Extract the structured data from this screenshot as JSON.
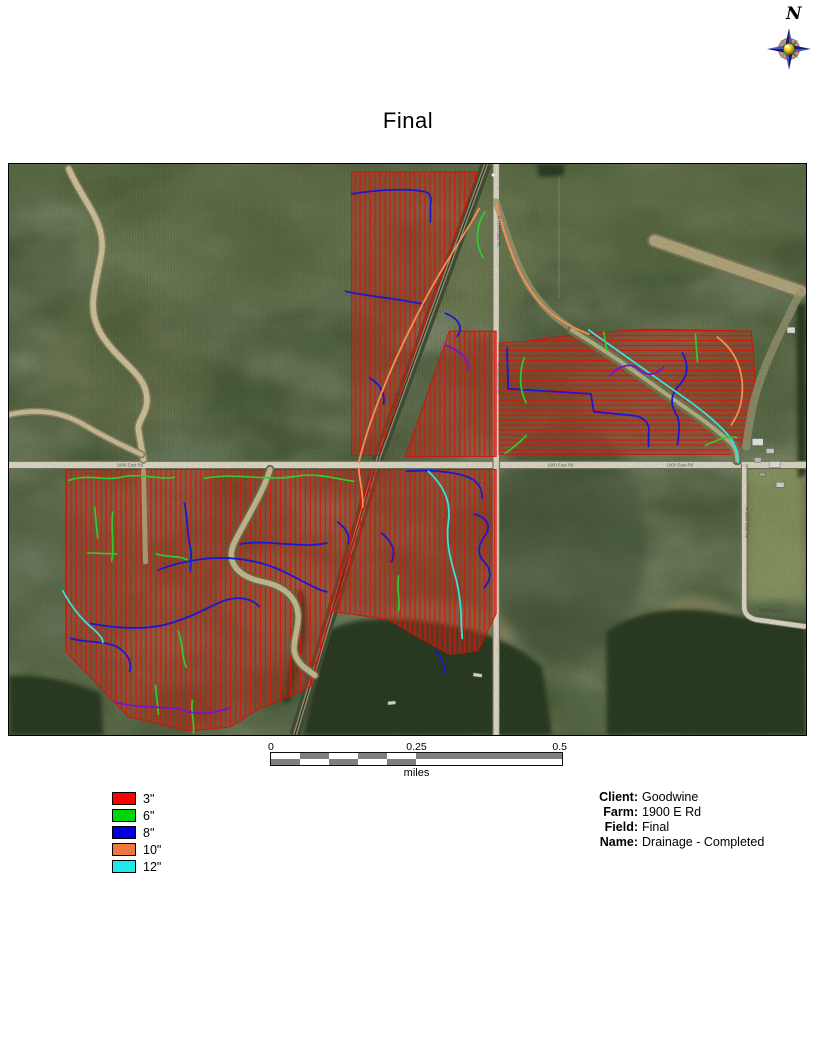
{
  "page": {
    "title": "Final"
  },
  "compass": {
    "label": "N"
  },
  "legend": {
    "items": [
      {
        "label": "3\"",
        "color": "#fb0000"
      },
      {
        "label": "6\"",
        "color": "#00d40a"
      },
      {
        "label": "8\"",
        "color": "#0000dd"
      },
      {
        "label": "10\"",
        "color": "#f07840"
      },
      {
        "label": "12\"",
        "color": "#20e8e8"
      }
    ]
  },
  "scale_bar": {
    "tick0": "0",
    "tick1": "0.25",
    "tick2": "0.5",
    "unit": "miles"
  },
  "info": {
    "rows": [
      {
        "label": "Client:",
        "value": "Goodwine"
      },
      {
        "label": "Farm:",
        "value": "1900 E Rd"
      },
      {
        "label": "Field:",
        "value": "Final"
      },
      {
        "label": "Name:",
        "value": "Drainage - Completed"
      }
    ]
  },
  "map": {
    "road_labels": [
      "1900 East Rd",
      "1900 East Rd",
      "1900 East Rd",
      "N 2100 East Rd",
      "N 2100 East Rd",
      "N 2200 East Rd",
      "1950 North Rd"
    ],
    "line_colors": {
      "3in": "#e01408",
      "6in": "#2ed32e",
      "8in": "#1a1ad8",
      "10in": "#ff9055",
      "12in": "#38e8e8",
      "main_purple": "#7716d8"
    }
  }
}
